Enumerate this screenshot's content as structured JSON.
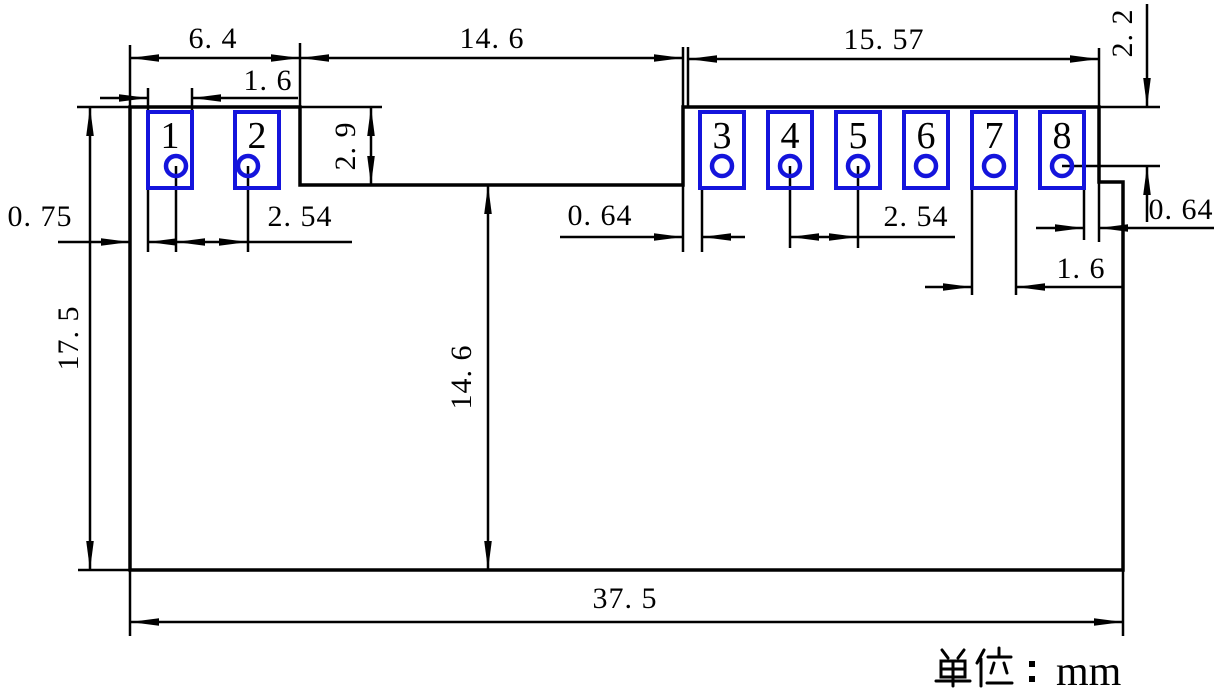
{
  "drawing": {
    "type": "mechanical-dimension-drawing",
    "unit_label": "单位：mm",
    "unit_value": "mm",
    "colors": {
      "outline": "#000000",
      "pad_outline": "#1414dc",
      "pad_number": "#c03038",
      "background": "#ffffff"
    },
    "pads": [
      {
        "number": "1"
      },
      {
        "number": "2"
      },
      {
        "number": "3"
      },
      {
        "number": "4"
      },
      {
        "number": "5"
      },
      {
        "number": "6"
      },
      {
        "number": "7"
      },
      {
        "number": "8"
      }
    ],
    "dimensions": {
      "top_left_section_width": "6. 4",
      "pad1_width": "1. 6",
      "top_middle_width": "14. 6",
      "top_right_section_width": "15. 57",
      "pad8_center_from_top": "2. 2",
      "left_step_depth": "2. 9",
      "pad1_left_margin": "0. 75",
      "left_pad_pitch": "2. 54",
      "pad3_left_gap": "0. 64",
      "right_pad_pitch": "2. 54",
      "pad8_right_gap": "0. 64",
      "pad7_width": "1. 6",
      "body_height": "17. 5",
      "lower_body_height": "14. 6",
      "body_width": "37. 5"
    }
  }
}
